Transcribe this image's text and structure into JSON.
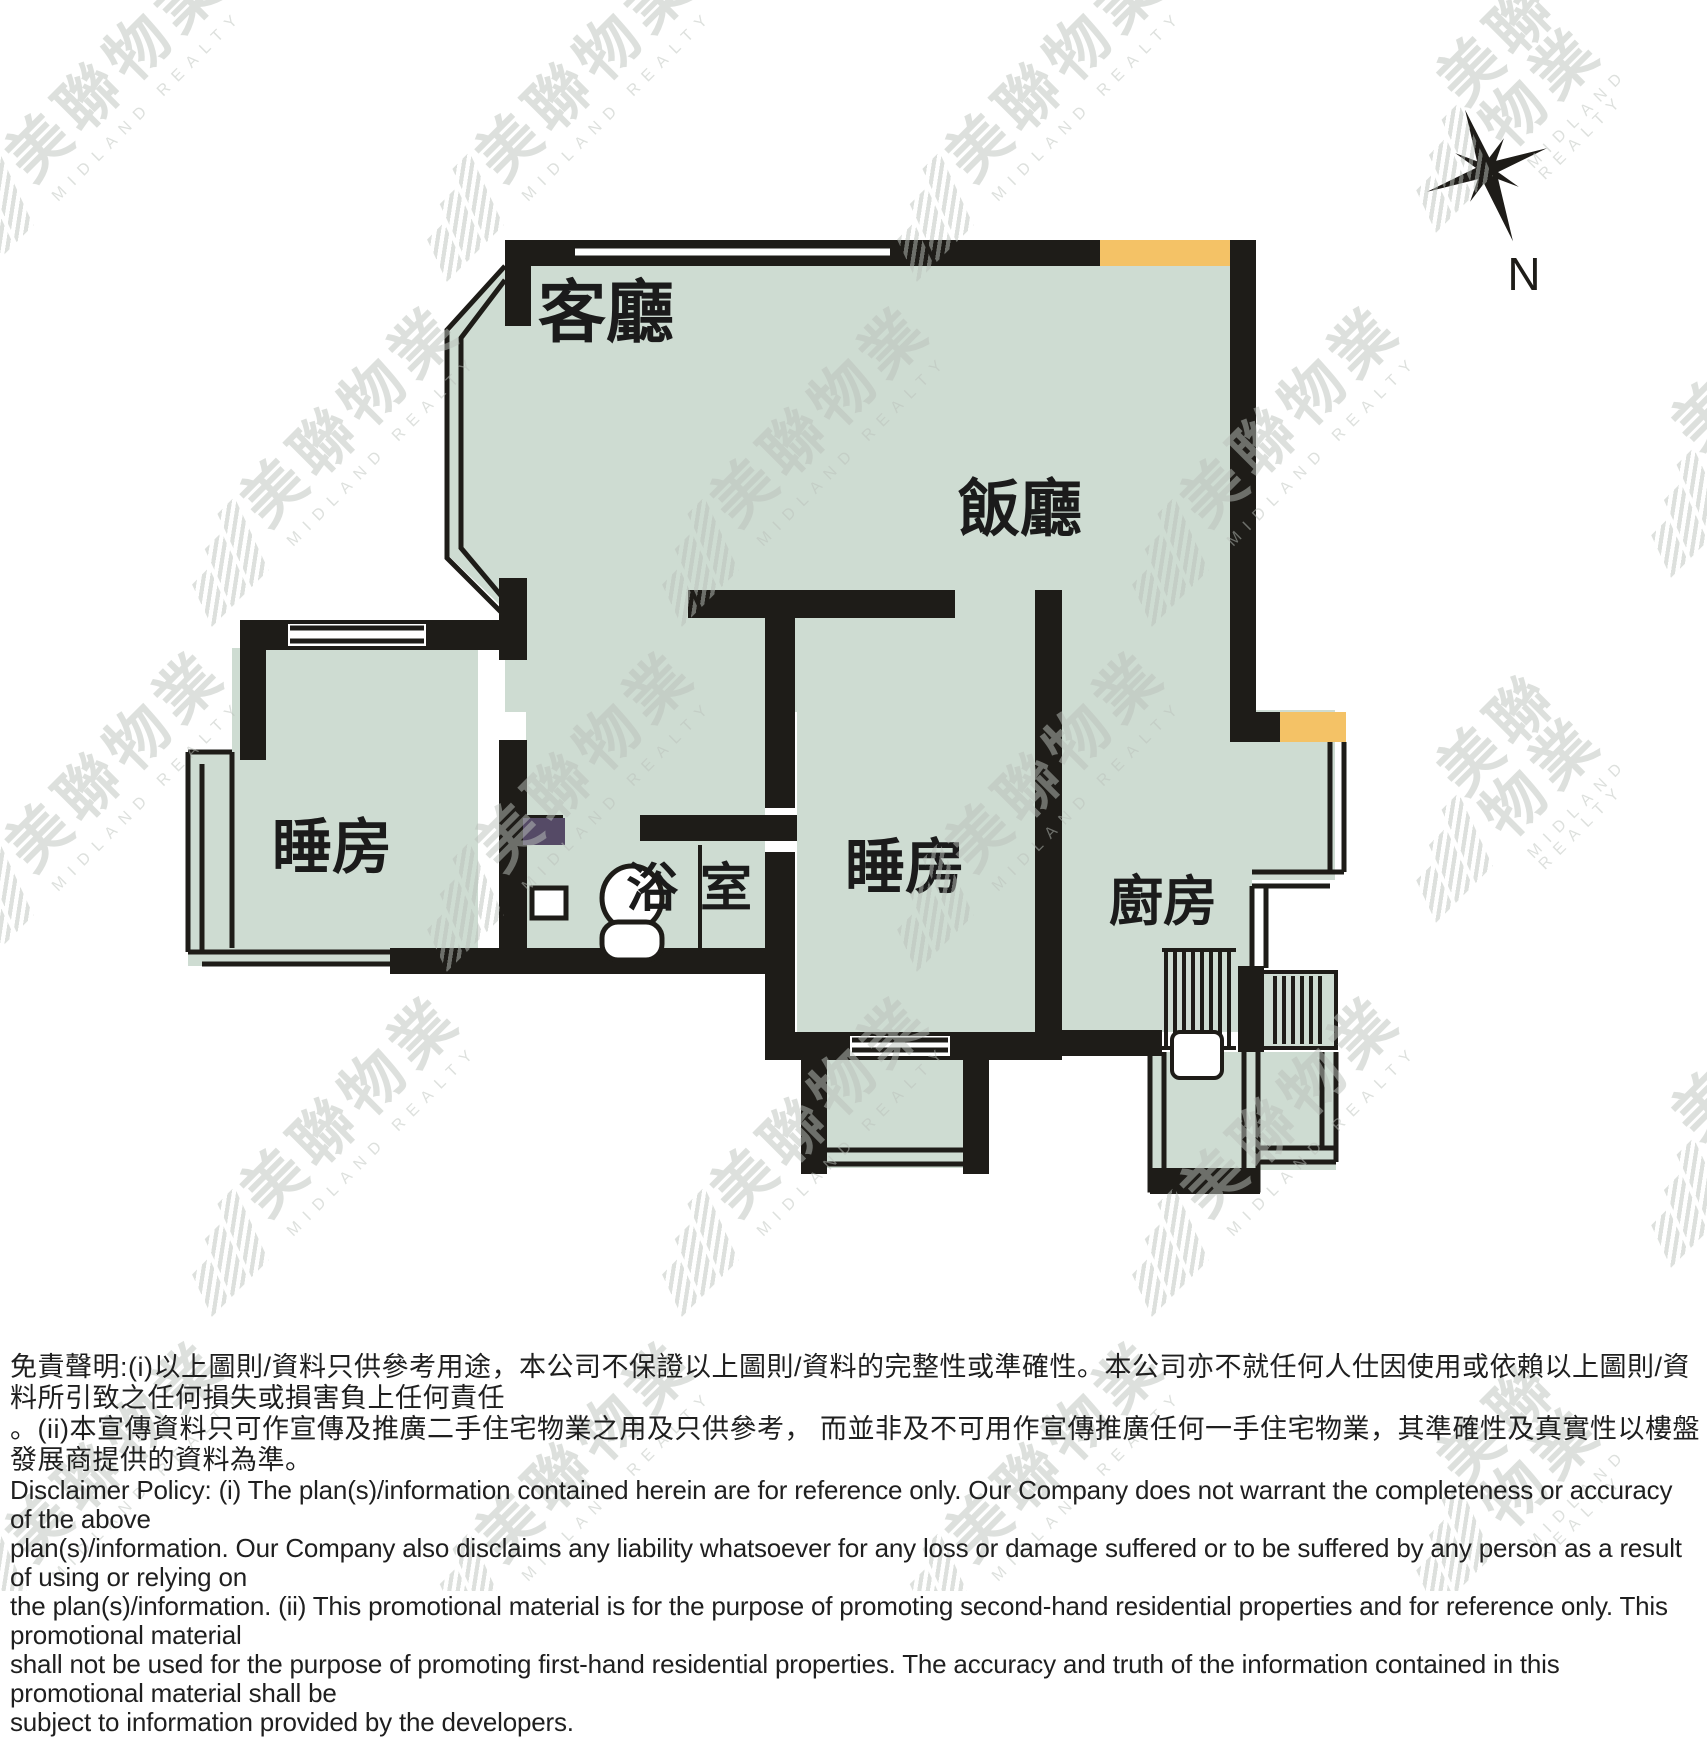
{
  "plan": {
    "rooms": {
      "living": "客廳",
      "dining": "飯廳",
      "bedroom_left": "睡房",
      "bedroom_center": "睡房",
      "bathroom": "浴室",
      "kitchen": "廚房"
    },
    "compass_label": "N"
  },
  "watermark": {
    "cjk": "美聯物業",
    "latin": "MIDLAND REALTY"
  },
  "disclaimer": {
    "zh_lines": [
      "免責聲明:(i)以上圖則/資料只供參考用途，本公司不保證以上圖則/資料的完整性或準確性。本公司亦不就任何人仕因使用或依賴以上圖則/資料所引致之任何損失或損害負上任何責任",
      "。(ii)本宣傳資料只可作宣傳及推廣二手住宅物業之用及只供參考， 而並非及不可用作宣傳推廣任何一手住宅物業，其準確性及真實性以樓盤發展商提供的資料為準。"
    ],
    "en_lines": [
      "Disclaimer Policy: (i) The plan(s)/information contained herein are for reference only. Our Company does not warrant the completeness or accuracy of the above",
      "plan(s)/information. Our Company also disclaims any liability whatsoever for any loss or damage suffered or to be suffered by any person as a result of using or relying on",
      "the plan(s)/information. (ii) This promotional material is for the purpose of promoting second-hand residential properties and for reference only. This promotional material",
      "shall not be used for the purpose of promoting first-hand residential properties. The accuracy and truth of the information contained in this promotional material shall be",
      "subject to information provided by the developers."
    ]
  },
  "colors": {
    "floor": "#cedcd2",
    "wall": "#1e1c18",
    "accent_orange": "#f4c266",
    "accent_purple": "#554a66",
    "label_ink": "#1b1b1b"
  }
}
